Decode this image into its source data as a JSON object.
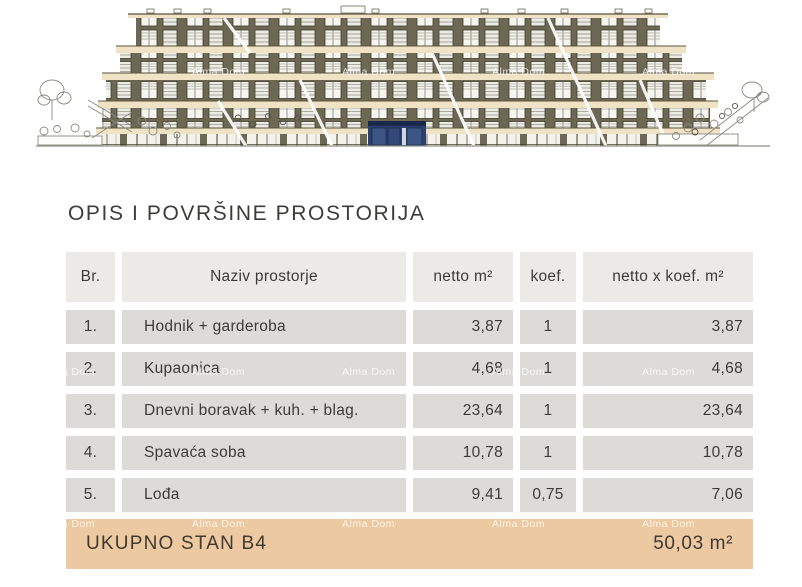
{
  "title": "OPIS I POVRŠINE PROSTORIJA",
  "watermark": {
    "text": "Alma Dom"
  },
  "table": {
    "headers": [
      "Br.",
      "Naziv prostorje",
      "netto m²",
      "koef.",
      "netto x koef. m²"
    ],
    "rows": [
      {
        "br": "1.",
        "naziv": "Hodnik + garderoba",
        "netto": "3,87",
        "koef": "1",
        "netto_x_koef": "3,87"
      },
      {
        "br": "2.",
        "naziv": "Kupaonica",
        "netto": "4,68",
        "koef": "1",
        "netto_x_koef": "4,68"
      },
      {
        "br": "3.",
        "naziv": "Dnevni boravak + kuh. + blag.",
        "netto": "23,64",
        "koef": "1",
        "netto_x_koef": "23,64"
      },
      {
        "br": "4.",
        "naziv": "Spavaća soba",
        "netto": "10,78",
        "koef": "1",
        "netto_x_koef": "10,78"
      },
      {
        "br": "5.",
        "naziv": "Lođa",
        "netto": "9,41",
        "koef": "0,75",
        "netto_x_koef": "7,06"
      }
    ],
    "total": {
      "label": "UKUPNO STAN B4",
      "value": "50,03 m²"
    }
  },
  "colors": {
    "total_bar_bg": "#ecc9a0",
    "table_header_bg": "#eceae7",
    "table_cell_bg": "#dcdbd8",
    "highlight_unit_blue": "#2c4170",
    "facade_olive": "#6c6853",
    "slab_cream": "#f0e3c5"
  }
}
